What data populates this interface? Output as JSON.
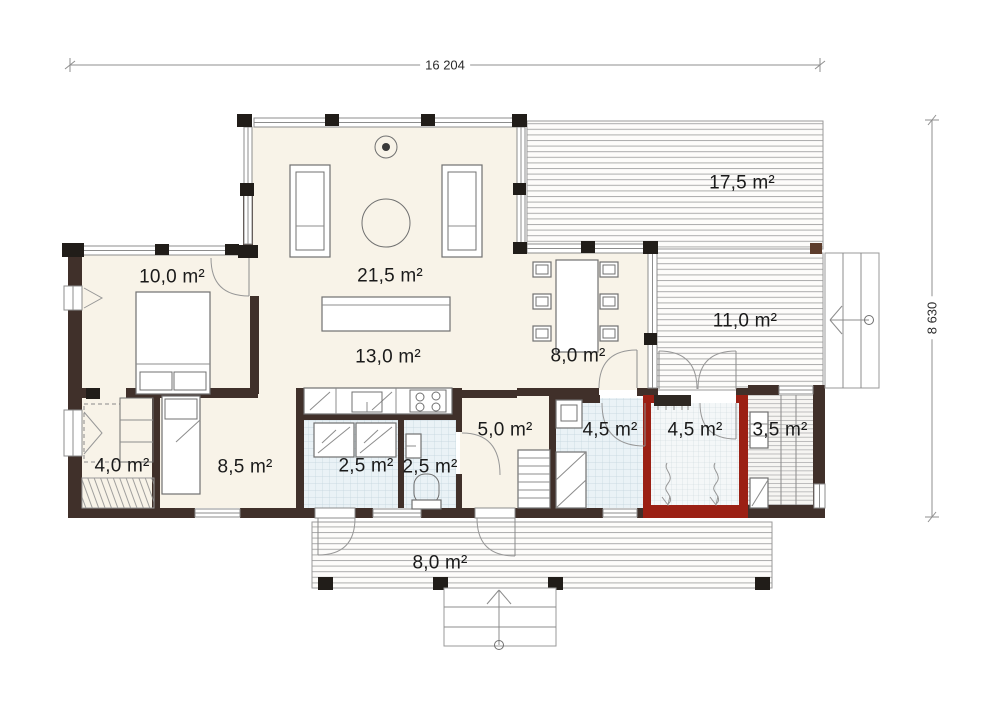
{
  "plan": {
    "type": "single-storey house floor plan",
    "dimensions": {
      "width_label": "16 204",
      "height_label": "8 630"
    },
    "rooms": {
      "terrace_top": {
        "area": "17,5 m²"
      },
      "bedroom_main": {
        "area": "10,0 m²"
      },
      "living_room": {
        "area": "21,5 m²"
      },
      "terrace_side": {
        "area": "11,0 m²"
      },
      "kitchen": {
        "area": "13,0 m²"
      },
      "dining": {
        "area": "8,0 m²"
      },
      "walk_in_closet": {
        "area": "4,0 m²"
      },
      "bedroom_second": {
        "area": "8,5 m²"
      },
      "utility": {
        "area": "2,5 m²"
      },
      "wc": {
        "area": "2,5 m²"
      },
      "hallway": {
        "area": "5,0 m²"
      },
      "bathroom": {
        "area": "4,5 m²"
      },
      "sauna": {
        "area": "4,5 m²"
      },
      "dressing": {
        "area": "3,5 m²"
      },
      "porch": {
        "area": "8,0 m²"
      }
    },
    "colors": {
      "wall": "#40302a",
      "sauna_wall": "#9b2014",
      "floor": "#f8f3e8",
      "tile_floor": "#eaf2f6",
      "deck_line": "#adadad",
      "label_text": "#1a1a1a"
    }
  }
}
